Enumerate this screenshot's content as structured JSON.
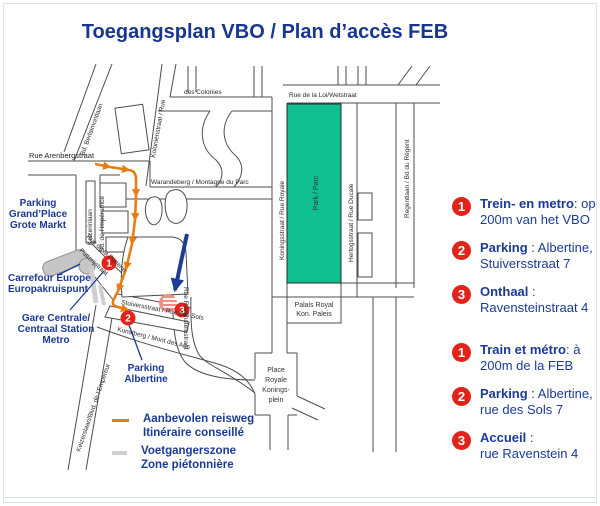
{
  "title": "Toegangsplan VBO / Plan d’accès FEB",
  "colors": {
    "accent_blue": "#1b3a94",
    "marker_red": "#e2231a",
    "route_orange": "#e87d13",
    "park_green": "#10bf8f",
    "pedestrian_gray": "#cfcfcf",
    "station_gray": "#c6c6c6"
  },
  "map": {
    "streets": {
      "arenberg": "Rue Arenbergstraat",
      "berlaimont": "Bd. Berlaimontlaan",
      "kolonien": "Koloniënstraat / Rue",
      "colonies": "des Colonies",
      "warandeberg": "Warandeberg / Montagne du Parc",
      "loi": "Rue de la Loi/Wetstraat",
      "royale": "Koningsstraat / Rue Royale",
      "ducale": "Hertogsstraat / Rue Ducale",
      "regent": "Regentlaan / Bd du Régent",
      "keizerinlaan": "Keizerinlaan",
      "imperatrice": "Bd. de l’Impératrice",
      "putterie_fr": "Rue de la Putterie",
      "putterie_nl": "Putterijstraat",
      "empereur": "Keizerslaan/Blvd. de l’Empereur",
      "sols": "Stuiversstraat / Rue des Sols",
      "kunstberg": "Kunstberg / Mont des Arts",
      "ravenstein": "Rue Ravensteinstraat"
    },
    "places": {
      "park": "Park / Parc",
      "palais": [
        "Palais Royal",
        "Kon. Paleis"
      ],
      "place_royale": [
        "Place",
        "Royale",
        "Konings-",
        "plein"
      ]
    },
    "poi": {
      "parking_grandplace": [
        "Parking",
        "Grand’Place",
        "Grote Markt"
      ],
      "carrefour": [
        "Carrefour Europe",
        "Europakruispunt"
      ],
      "gare": [
        "Gare Centrale/",
        "Centraal Station",
        "Metro"
      ],
      "parking_albertine": [
        "Parking",
        "Albertine"
      ]
    },
    "markers": {
      "m1": "1",
      "m2": "2",
      "m3": "3"
    }
  },
  "legend": {
    "route": {
      "line1": "Aanbevolen reisweg",
      "line2": "Itinéraire conseillé"
    },
    "pedestrian": {
      "line1": "Voetgangerszone",
      "line2": "Zone piétonnière"
    }
  },
  "sidebar": {
    "nl": [
      {
        "num": "1",
        "bold": "Trein- en metro",
        "rest": ":  op",
        "line2": "200m van het VBO"
      },
      {
        "num": "2",
        "bold": "Parking",
        "rest": " : Albertine,",
        "line2": "Stuiversstraat 7"
      },
      {
        "num": "3",
        "bold": "Onthaal",
        "rest": " :",
        "line2": "Ravensteinstraat 4"
      }
    ],
    "fr": [
      {
        "num": "1",
        "bold": "Train et métro",
        "rest": ": à",
        "line2": "200m de la FEB"
      },
      {
        "num": "2",
        "bold": "Parking",
        "rest": " : Albertine,",
        "line2": "rue des Sols 7"
      },
      {
        "num": "3",
        "bold": "Accueil",
        "rest": " :",
        "line2": "rue Ravenstein 4"
      }
    ]
  }
}
